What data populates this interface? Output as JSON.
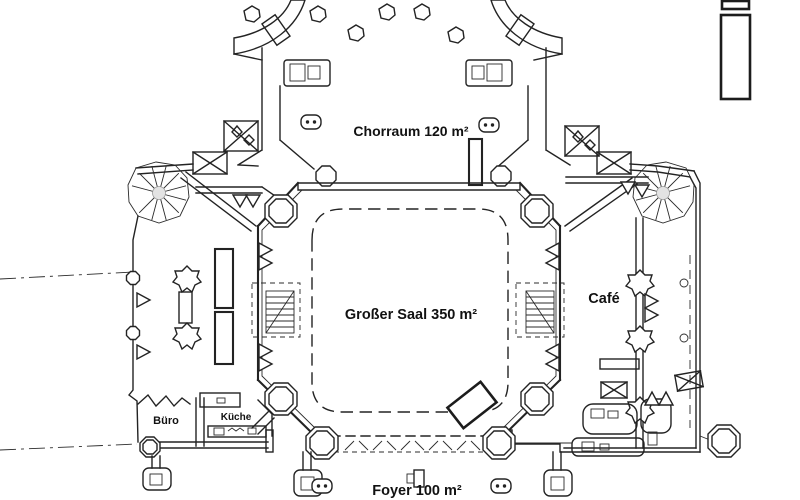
{
  "colors": {
    "background": "#ffffff",
    "line": "#232323",
    "label_text": "#111111",
    "stair_center_fill": "#e3e3e3"
  },
  "rooms": [
    {
      "id": "chorraum",
      "label": "Chorraum 120 m²"
    },
    {
      "id": "grosser-saal",
      "label": "Großer Saal 350 m²"
    },
    {
      "id": "cafe",
      "label": "Café"
    },
    {
      "id": "buero",
      "label": "Büro"
    },
    {
      "id": "kueche",
      "label": "Küche"
    },
    {
      "id": "foyer",
      "label": "Foyer 100 m²"
    }
  ]
}
